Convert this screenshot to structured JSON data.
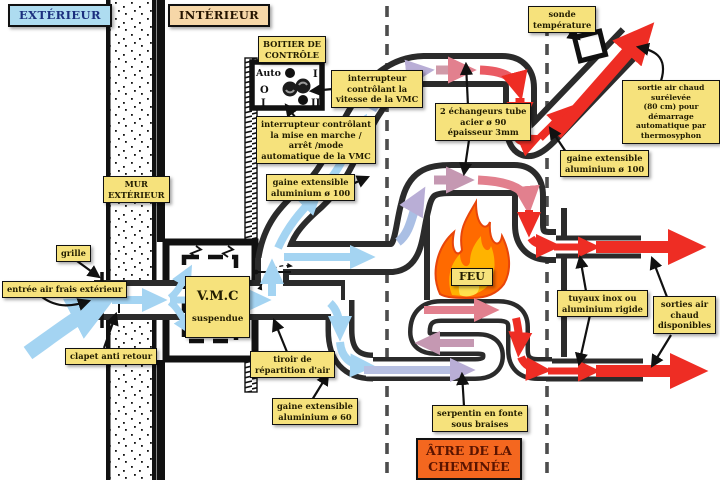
{
  "zones": {
    "exterior": "EXTÉRIEUR",
    "interior": "INTÉRIEUR",
    "wall": "MUR\nEXTÉRIEUR",
    "hearth": "ÂTRE DE LA\nCHEMINÉE"
  },
  "control_box": {
    "title": "BOITIER DE\nCONTRÔLE",
    "auto_label": "Auto",
    "off_label": "O",
    "on_left_label": "I",
    "speed1_label": "I",
    "speed2_label": "II"
  },
  "vmc": {
    "name": "V.M.C",
    "state": "suspendue"
  },
  "fire": {
    "label": "FEU"
  },
  "annotations": {
    "speed_switch": "interrupteur\ncontrôlant la\nvitesse de la VMC",
    "power_switch": "interrupteur contrôlant\nla mise en marche /\narrêt /mode\nautomatique de la VMC",
    "duct100_left": "gaine extensible\naluminium ø 100",
    "duct100_right": "gaine extensible\naluminium ø 100",
    "duct60": "gaine extensible\naluminium ø 60",
    "probe": "sonde\ntempérature",
    "outlet_thermosyphon": "sortie air chaud surélevée\n(80 cm) pour démarrage\nautomatique par\nthermosyphon",
    "exchangers": "2 échangeurs tube\nacier ø 90\népaisseur 3mm",
    "pipes": "tuyaux inox ou\naluminium rigide",
    "hot_outlets": "sorties air\nchaud\ndisponibles",
    "coil": "serpentin en fonte\nsous braises",
    "drawer": "tiroir de\nrépartition d'air",
    "grille": "grille",
    "fresh_air": "entrée air frais extérieur",
    "check_valve": "clapet anti retour"
  },
  "colors": {
    "label_bg": "#f6e27c",
    "cold_air": "#a4d4f2",
    "hot_air": "#ee2d24",
    "warm_mauve": "#c598b2",
    "hearth_bg": "#f4671f",
    "duct_wall": "#2b2b2b",
    "exterior_bg": "#aedcf0",
    "interior_bg": "#f6d7a8"
  }
}
